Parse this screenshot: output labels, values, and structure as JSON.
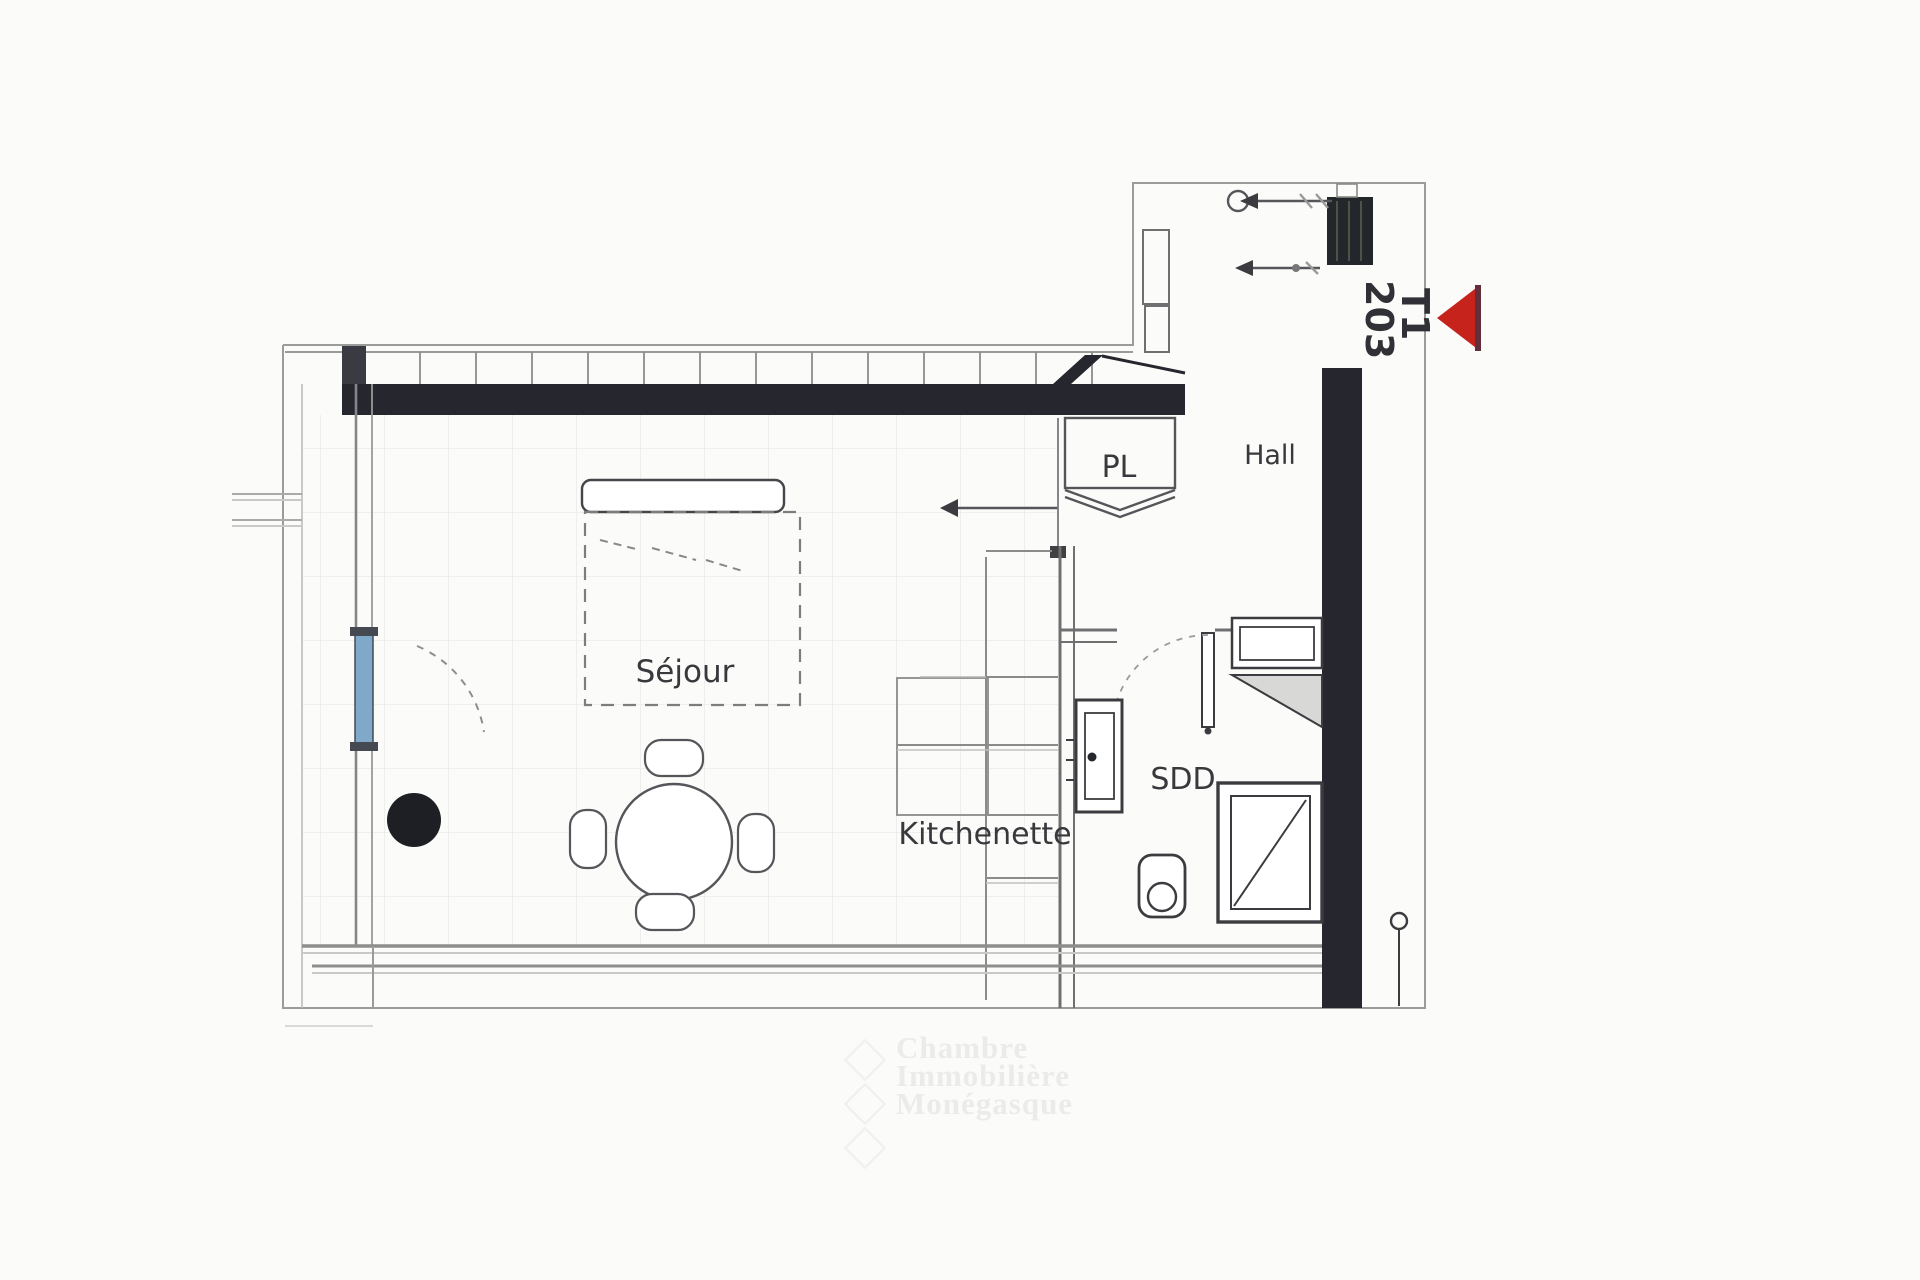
{
  "plan": {
    "unit": {
      "number": "203",
      "type": "T1"
    },
    "rooms": {
      "sejour": "Séjour",
      "kitchenette": "Kitchenette",
      "hall": "Hall",
      "sdd": "SDD",
      "closet": "PL"
    },
    "colors": {
      "wall_dark": "#26272e",
      "entrance_marker_red": "#c6231c",
      "window_blue": "#7fa8c9",
      "line_gray": "#6e6e72",
      "tile_grid": "#e8e8e6"
    }
  },
  "watermark": {
    "line1": "Chambre",
    "line2": "Immobilière",
    "line3": "Monégasque"
  }
}
